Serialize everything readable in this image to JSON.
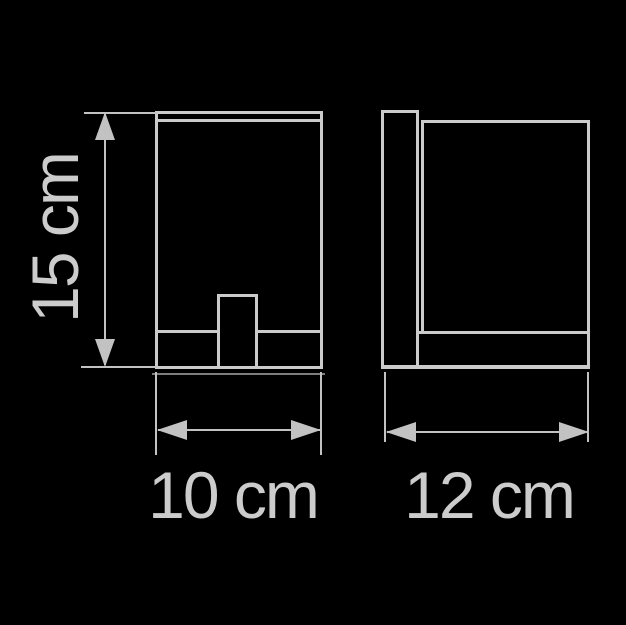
{
  "dimensions": {
    "height": {
      "label": "15 cm",
      "value": 15,
      "unit": "cm"
    },
    "width": {
      "label": "10 cm",
      "value": 10,
      "unit": "cm"
    },
    "depth": {
      "label": "12 cm",
      "value": 12,
      "unit": "cm"
    }
  },
  "colors": {
    "background": "#000000",
    "line": "#cbcbcb",
    "dimension_line": "#c2c2c2",
    "faint_line": "#7e7e7e",
    "text": "#cccccc"
  }
}
